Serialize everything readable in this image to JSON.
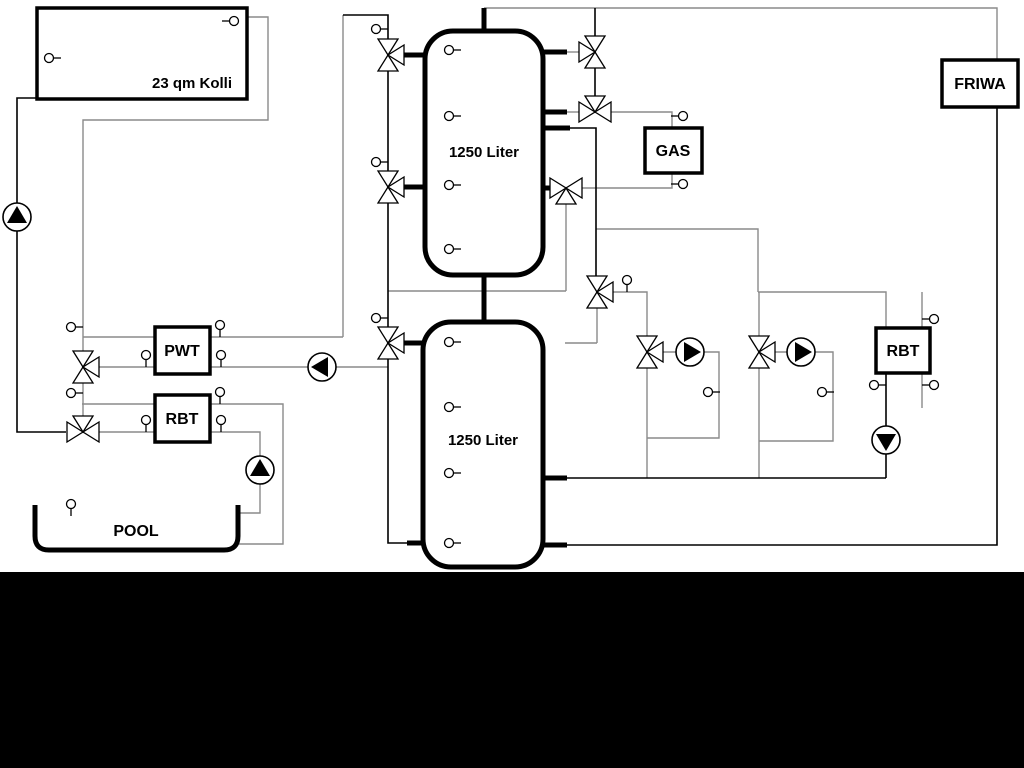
{
  "diagram": {
    "title": "Solar / buffer-tank hydraulic schematic",
    "labels": {
      "collector": "23 qm Kolli",
      "tank_upper": "1250 Liter",
      "tank_lower": "1250 Liter",
      "pwt": "PWT",
      "rbt_left": "RBT",
      "rbt_right": "RBT",
      "gas": "GAS",
      "friwa": "FRIWA",
      "pool": "POOL"
    },
    "colors": {
      "background": "#ffffff",
      "pipe_gray": "#8a8a8a",
      "pipe_black": "#000000",
      "bottom_band": "#000000"
    },
    "components": {
      "boxes": [
        "collector",
        "PWT",
        "RBT (pool)",
        "GAS",
        "RBT (heating)",
        "FRIWA"
      ],
      "tanks": [
        "1250 Liter buffer (top)",
        "1250 Liter buffer (bottom)"
      ],
      "pumps": 6,
      "three_way_valves": 11,
      "temperature_sensors": 30
    }
  }
}
